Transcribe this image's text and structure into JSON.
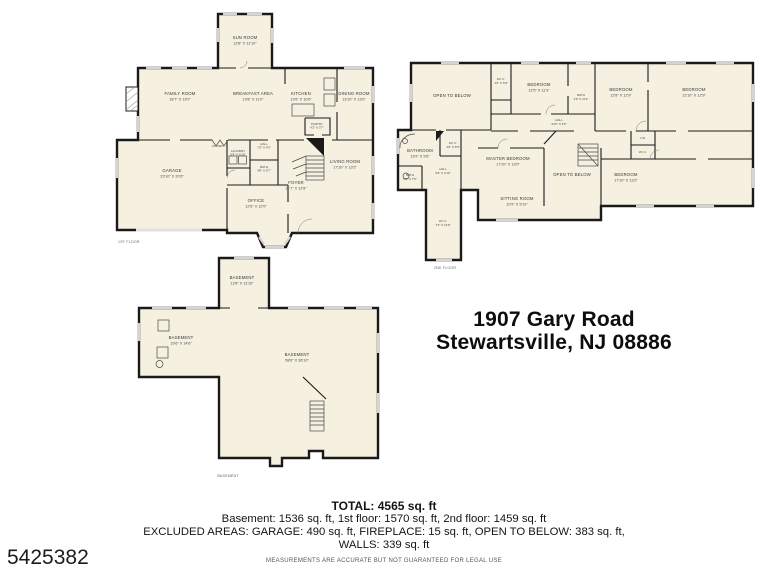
{
  "mls_number": "5425382",
  "address": {
    "line1": "1907 Gary Road",
    "line2": "Stewartsville, NJ 08886"
  },
  "summary": {
    "total": "TOTAL: 4565 sq. ft",
    "floors_line": "Basement: 1536 sq. ft, 1st floor: 1570 sq. ft, 2nd floor: 1459 sq. ft",
    "excluded_line": "EXCLUDED AREAS: GARAGE: 490 sq. ft, FIREPLACE: 15 sq. ft, OPEN TO BELOW: 383 sq. ft,",
    "walls_line": "WALLS: 339 sq. ft",
    "disclaimer": "MEASUREMENTS ARE ACCURATE BUT NOT GUARANTEED FOR LEGAL USE"
  },
  "colors": {
    "plan_fill": "#f5f0df",
    "wall": "#1a1a1a",
    "window": "#d4d4d4",
    "text": "#141414"
  },
  "floors": {
    "first": {
      "caption": "1ST FLOOR",
      "rooms": [
        {
          "name": "SUN ROOM",
          "dims": "12'8\" X 11'10\""
        },
        {
          "name": "FAMILY ROOM",
          "dims": "18'7\" X 13'0\""
        },
        {
          "name": "BREAKFAST AREA",
          "dims": "13'8\" X 11'0\""
        },
        {
          "name": "KITCHEN",
          "dims": "13'6\" X 10'6\""
        },
        {
          "name": "DINING ROOM",
          "dims": "13'10\" X 13'0\""
        },
        {
          "name": "GARAGE",
          "dims": "23'10\" X 20'6\""
        },
        {
          "name": "LAUNDRY",
          "dims": "5'8\" X 6'10\""
        },
        {
          "name": "BATH",
          "dims": "4'8\" X 5'7\""
        },
        {
          "name": "HALL",
          "dims": "7'0\" X 4'3\""
        },
        {
          "name": "PANTRY",
          "dims": "4'2\" X 3'7\""
        },
        {
          "name": "FOYER",
          "dims": "11'7\" X 12'8\""
        },
        {
          "name": "OFFICE",
          "dims": "12'6\" X 12'0\""
        },
        {
          "name": "LIVING ROOM",
          "dims": "17'10\" X 13'2\""
        },
        {
          "name": "CLOSET",
          "dims": ""
        }
      ]
    },
    "second": {
      "caption": "2ND FLOOR",
      "rooms": [
        {
          "name": "OPEN TO BELOW",
          "dims": ""
        },
        {
          "name": "W.I.C.",
          "dims": "4'2\" X 5'8\""
        },
        {
          "name": "BEDROOM",
          "dims": "12'5\" X 11'3\""
        },
        {
          "name": "BATH",
          "dims": "4'9\" X 11'2\""
        },
        {
          "name": "BEDROOM",
          "dims": "12'8\" X 12'9\""
        },
        {
          "name": "BEDROOM",
          "dims": "12'10\" X 12'9\""
        },
        {
          "name": "HALL",
          "dims": "24'6\" X 3'5\""
        },
        {
          "name": "BATHROOM",
          "dims": "13'9\" X 9'6\""
        },
        {
          "name": "W.I.C.",
          "dims": "4'6\" X 5'5\""
        },
        {
          "name": "HALL",
          "dims": "9'6\" X 2'10\""
        },
        {
          "name": "BATH",
          "dims": "6'3\" X 7'0\""
        },
        {
          "name": "MASTER BEDROOM",
          "dims": "17'10\" X 13'0\""
        },
        {
          "name": "SITTING ROOM",
          "dims": "10'9\" X 9'10\""
        },
        {
          "name": "OPEN TO BELOW",
          "dims": ""
        },
        {
          "name": "BEDROOM",
          "dims": "17'10\" X 13'2\""
        },
        {
          "name": "W.I.C.",
          "dims": "7'4\" X 14'6\""
        },
        {
          "name": "LIN.",
          "dims": ""
        },
        {
          "name": "W.I.C.",
          "dims": ""
        }
      ]
    },
    "basement": {
      "caption": "BASEMENT",
      "rooms": [
        {
          "name": "BASEMENT",
          "dims": "12'8\" X 11'10\""
        },
        {
          "name": "BASEMENT",
          "dims": "19'6\" X 14'6\""
        },
        {
          "name": "BASEMENT",
          "dims": "58'6\" X 36'10\""
        }
      ]
    }
  }
}
